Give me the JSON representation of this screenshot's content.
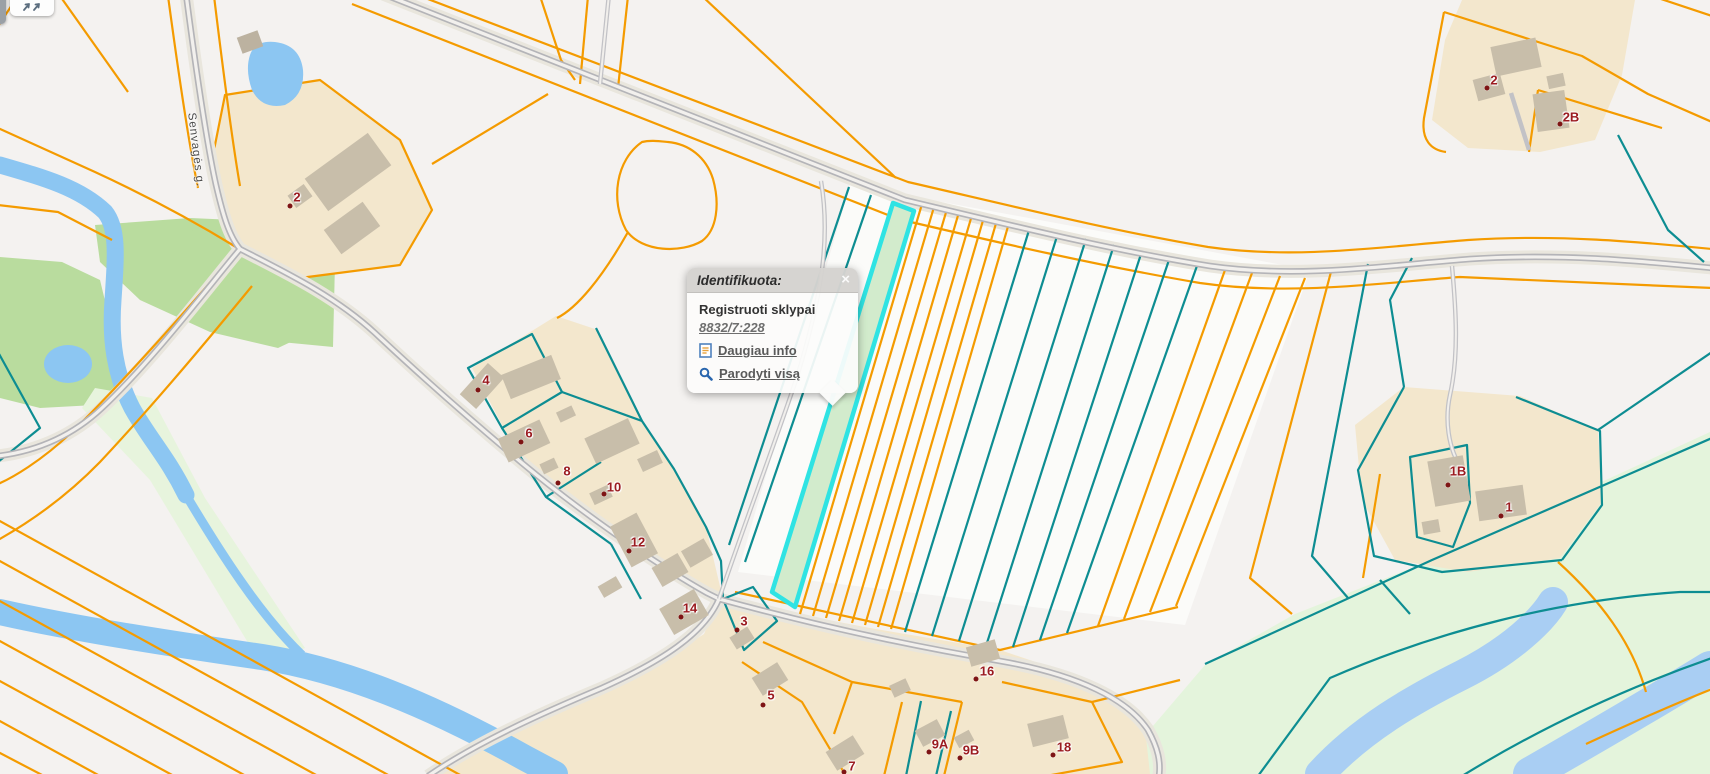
{
  "app": {
    "kind": "cadastral-map-viewer"
  },
  "popup": {
    "title": "Identifikuota:",
    "close_glyph": "×",
    "section_title": "Registruoti sklypai",
    "parcel_id": "8832/7:228",
    "links": [
      {
        "label": "Daugiau info",
        "icon": "document-icon"
      },
      {
        "label": "Parodyti visą",
        "icon": "magnifier-icon"
      }
    ]
  },
  "street_label": "Senvagės g.",
  "parcel_labels": [
    {
      "text": "2"
    },
    {
      "text": "4"
    },
    {
      "text": "6"
    },
    {
      "text": "8"
    },
    {
      "text": "10"
    },
    {
      "text": "12"
    },
    {
      "text": "14"
    },
    {
      "text": "3"
    },
    {
      "text": "5"
    },
    {
      "text": "7"
    },
    {
      "text": "9A"
    },
    {
      "text": "9B"
    },
    {
      "text": "16"
    },
    {
      "text": "18"
    },
    {
      "text": "2"
    },
    {
      "text": "2B"
    },
    {
      "text": "1B"
    },
    {
      "text": "1"
    }
  ],
  "colors": {
    "boundary_orange": "#f49b00",
    "boundary_teal": "#0d8d92",
    "selected_outline": "#2fe3e3",
    "selected_fill": "#d2ebcc",
    "water": "#8cc6f2",
    "water_light": "#a9cef3",
    "green": "#b9dc9e",
    "green_pale": "#e4f4dc",
    "residential": "#f3e7cd",
    "building": "#c8beaa",
    "road_core": "#b4b4b8",
    "label_red": "#9b1b20"
  },
  "icons": {
    "toolbar": "pan-arrows-icon",
    "popup_close": "close-icon",
    "more_info": "document-icon",
    "show_all": "magnifier-icon"
  }
}
